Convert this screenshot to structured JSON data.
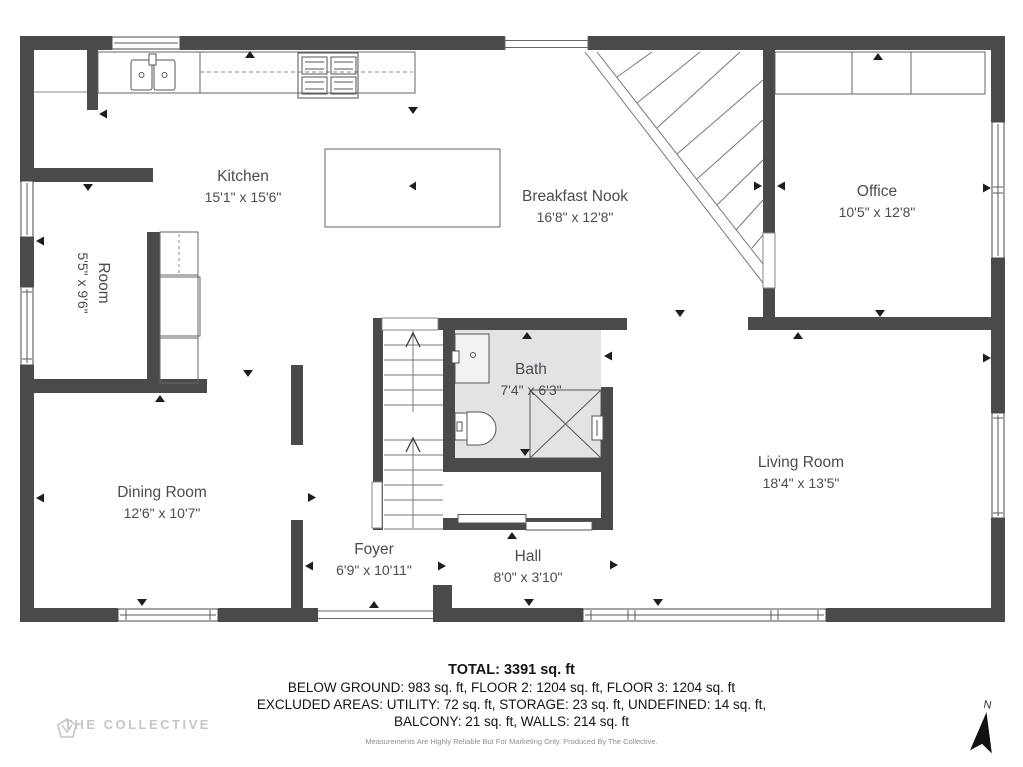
{
  "plan": {
    "rooms": [
      {
        "name": "Kitchen",
        "dims": "15'1\" x 15'6\""
      },
      {
        "name": "Breakfast Nook",
        "dims": "16'8\" x 12'8\""
      },
      {
        "name": "Office",
        "dims": "10'5\" x 12'8\""
      },
      {
        "name": "Room",
        "dims": "5'5\" x 9'6\""
      },
      {
        "name": "Dining Room",
        "dims": "12'6\" x 10'7\""
      },
      {
        "name": "Bath",
        "dims": "7'4\" x 6'3\""
      },
      {
        "name": "Living Room",
        "dims": "18'4\" x 13'5\""
      },
      {
        "name": "Foyer",
        "dims": "6'9\" x 10'11\""
      },
      {
        "name": "Hall",
        "dims": "8'0\" x 3'10\""
      }
    ],
    "summary": {
      "total": "TOTAL: 3391 sq. ft",
      "line2": "BELOW GROUND: 983 sq. ft, FLOOR 2: 1204 sq. ft, FLOOR 3: 1204 sq. ft",
      "line3": "EXCLUDED AREAS: UTILITY: 72 sq. ft, STORAGE: 23 sq. ft, UNDEFINED: 14 sq. ft,",
      "line4": "BALCONY: 21 sq. ft, WALLS: 214 sq. ft",
      "disclaimer": "Measurements Are Highly Reliable But For Marketing Only. Produced By The Collective."
    },
    "branding": {
      "logo_text": "THE COLLECTIVE"
    },
    "compass": {
      "label": "N"
    },
    "colors": {
      "wall": "#4a4a4a",
      "bath_floor": "#e3e3e3",
      "label_text": "#474d52",
      "logo": "#c6c6c6"
    }
  }
}
